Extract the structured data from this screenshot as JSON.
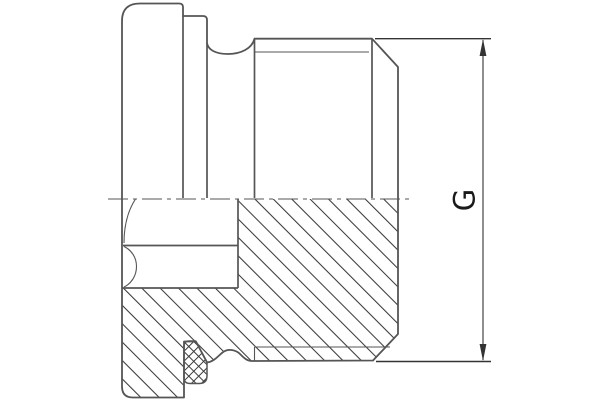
{
  "drawing": {
    "type": "technical-section-drawing",
    "dimension": {
      "label": "G"
    },
    "colors": {
      "outline": "#555555",
      "detail": "#333333",
      "hatch": "#3a3a3a",
      "text": "#1a1a1a",
      "background": "#ffffff"
    }
  }
}
